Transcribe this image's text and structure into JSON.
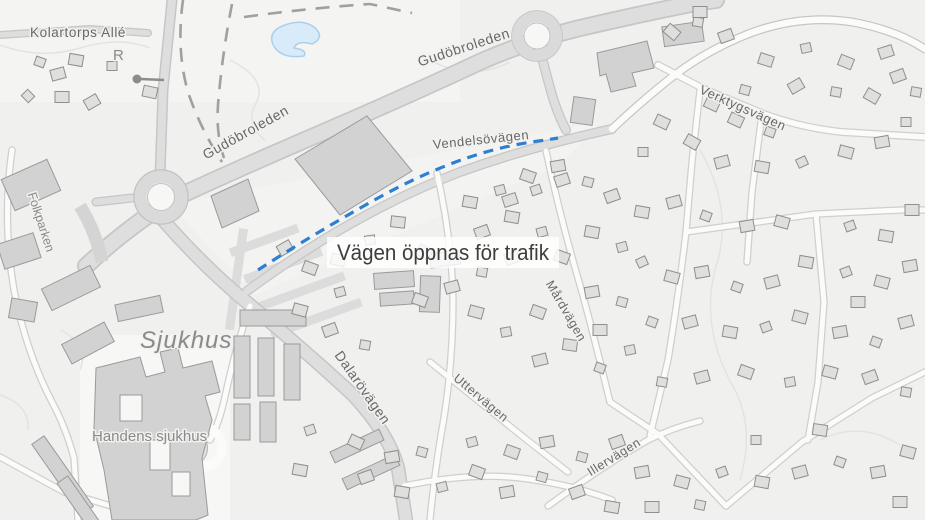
{
  "map": {
    "annotation": {
      "text": "Vägen öppnas för trafik"
    },
    "road_labels": {
      "kolartorps_alle": "Kolartorps Allé",
      "gudobroleden_upper": "Gudöbroleden",
      "gudobroleden_lower": "Gudöbroleden",
      "vendelsovagen": "Vendelsövägen",
      "verktygsvagen": "Verktygsvägen",
      "dalarovagen": "Dalarövägen",
      "mardvagen": "Mårdvägen",
      "uttervagen": "Uttervägen",
      "illervagen": "Illervägen"
    },
    "place_labels": {
      "folkparken": "Folkparken",
      "sjukhus": "Sjukhus",
      "handens_sjukhus": "Handens sjukhus",
      "rune_symbol": "R"
    },
    "colors": {
      "background": "#f0f0ee",
      "water": "#d9ebf9",
      "water_outline": "#abd0ec",
      "building": "#d2d2d2",
      "road_major": "#dcdcdc",
      "route_highlight": "#2d7fd3",
      "label_text": "#686868",
      "annotation_text": "#3d3d3d"
    }
  }
}
